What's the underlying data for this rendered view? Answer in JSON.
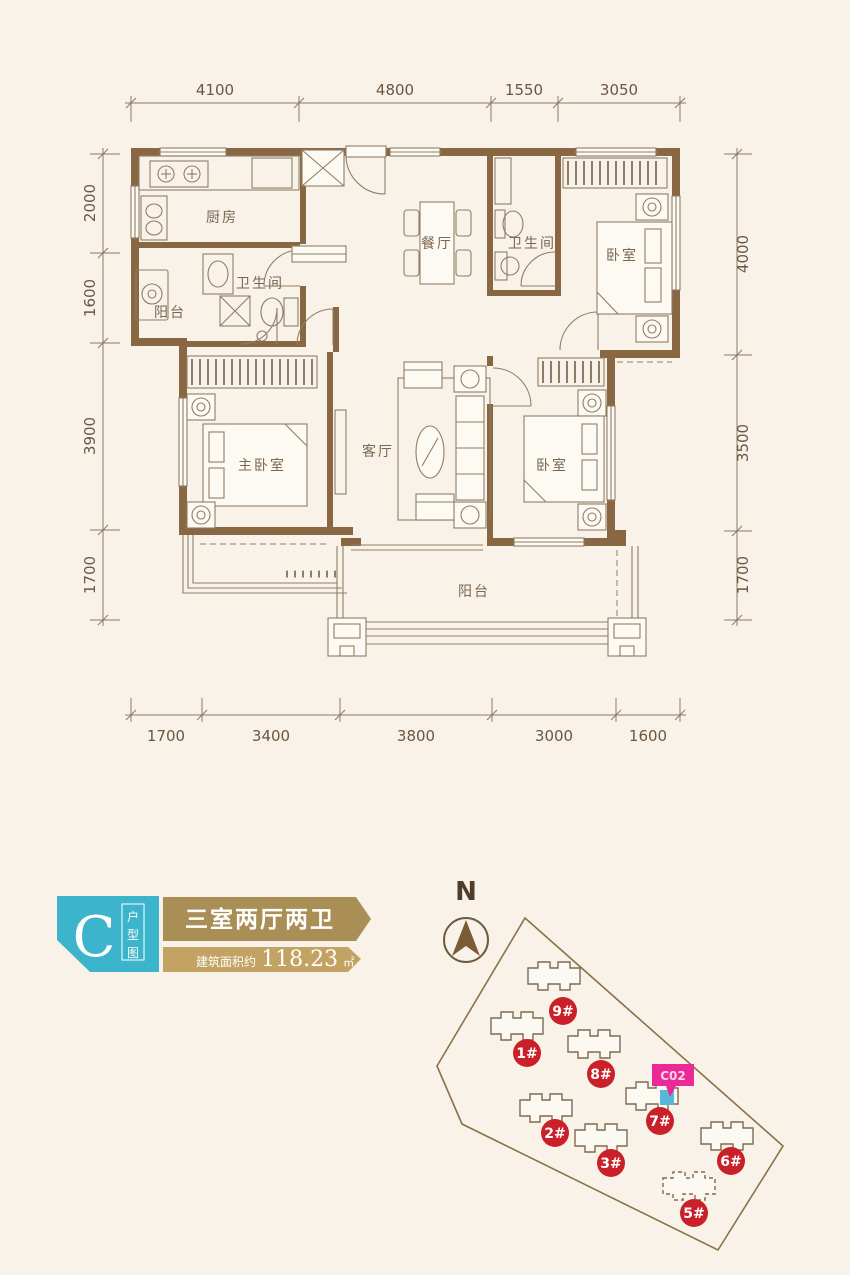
{
  "floor_plan": {
    "dims_top": [
      "4100",
      "4800",
      "1550",
      "3050"
    ],
    "dims_bottom": [
      "1700",
      "3400",
      "3800",
      "3000",
      "1600"
    ],
    "dims_left": [
      "2000",
      "1600",
      "3900",
      "1700"
    ],
    "dims_right": [
      "4000",
      "3500",
      "1700"
    ],
    "rooms": {
      "kitchen": "厨房",
      "balcony_side": "阳台",
      "bath_main": "卫生间",
      "dining": "餐厅",
      "bath_guest": "卫生间",
      "bedroom_top": "卧室",
      "master_bedroom": "主卧室",
      "living": "客厅",
      "bedroom_right": "卧室",
      "balcony_main": "阳台"
    }
  },
  "unit_badge": {
    "letter": "C",
    "tag_chars": [
      "户",
      "型",
      "图"
    ],
    "title": "三室两厅两卫",
    "area_prefix": "建筑面积约",
    "area_value": "118.23",
    "area_unit": "㎡"
  },
  "site_plan": {
    "north": "N",
    "highlight": "C02",
    "buildings": [
      "9#",
      "1#",
      "8#",
      "7#",
      "2#",
      "3#",
      "6#",
      "5#"
    ]
  },
  "colors": {
    "background": "#f9f2e8",
    "wall_brown": "#8a6743",
    "line_brown": "#8f7d66",
    "dim_text": "#6a5743",
    "badge_cyan": "#3cb4cc",
    "banner_gold_dark": "#a98e56",
    "banner_gold_light": "#c3a364",
    "building_badge_red": "#c9202a",
    "highlight_magenta": "#ea2a96",
    "highlight_unit_cyan": "#56b8d8"
  }
}
